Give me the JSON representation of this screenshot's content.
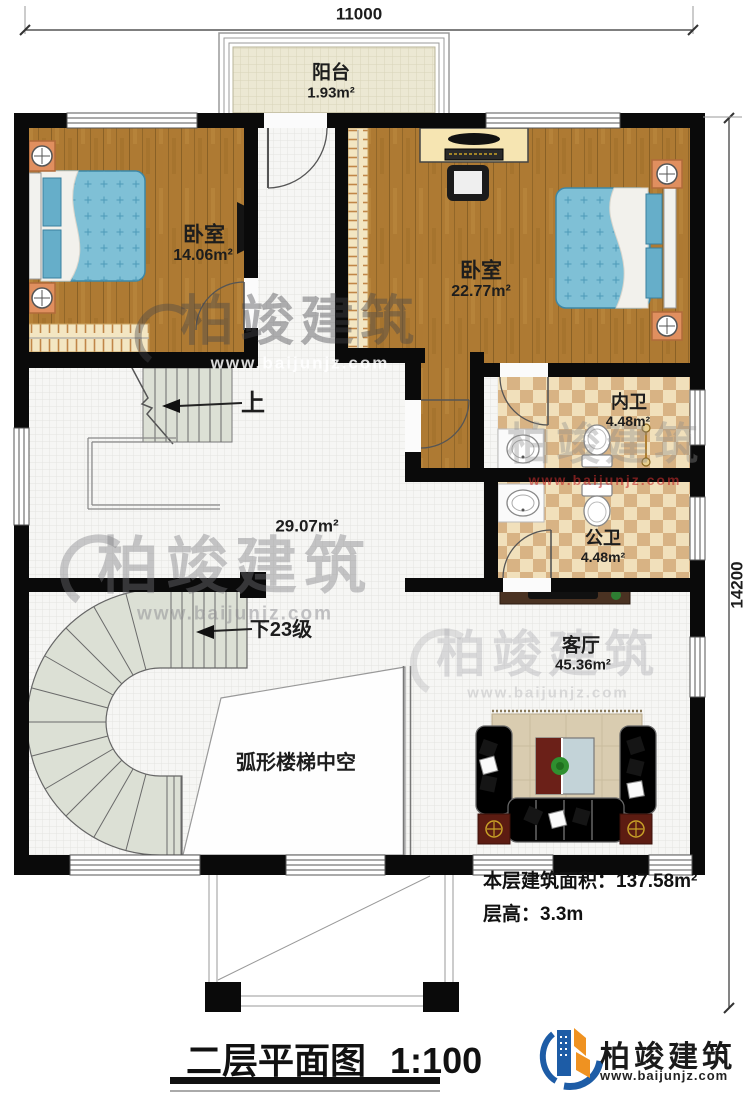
{
  "dimensions": {
    "width_top": "11000",
    "height_right": "14200"
  },
  "rooms": {
    "balcony": {
      "name": "阳台",
      "area": "1.93m²"
    },
    "bedroom_left": {
      "name": "卧室",
      "area": "14.06m²"
    },
    "bedroom_right": {
      "name": "卧室",
      "area": "22.77m²"
    },
    "inner_bathroom": {
      "name": "内卫",
      "area": "4.48m²"
    },
    "public_bathroom": {
      "name": "公卫",
      "area": "4.48m²"
    },
    "hall": {
      "area": "29.07m²"
    },
    "living_room": {
      "name": "客厅",
      "area": "45.36m²"
    }
  },
  "stairs": {
    "up_label": "上",
    "down_label": "下23级",
    "void_label": "弧形楼梯中空"
  },
  "notes": {
    "floor_area": "本层建筑面积：137.58m²",
    "floor_height": "层高：3.3m"
  },
  "title": {
    "text": "二层平面图",
    "scale": "1:100"
  },
  "brand": {
    "name": "柏竣建筑",
    "site": "www.baijunjz.com"
  },
  "colors": {
    "wall": "#0a0a0a",
    "wood": "#ae7a33",
    "bath_tile": "#d8b384",
    "stair": "#dce0d5",
    "brand_blue": "#1d5ca6",
    "brand_orange": "#ef9221",
    "watermark_red": "#c42b2b"
  }
}
